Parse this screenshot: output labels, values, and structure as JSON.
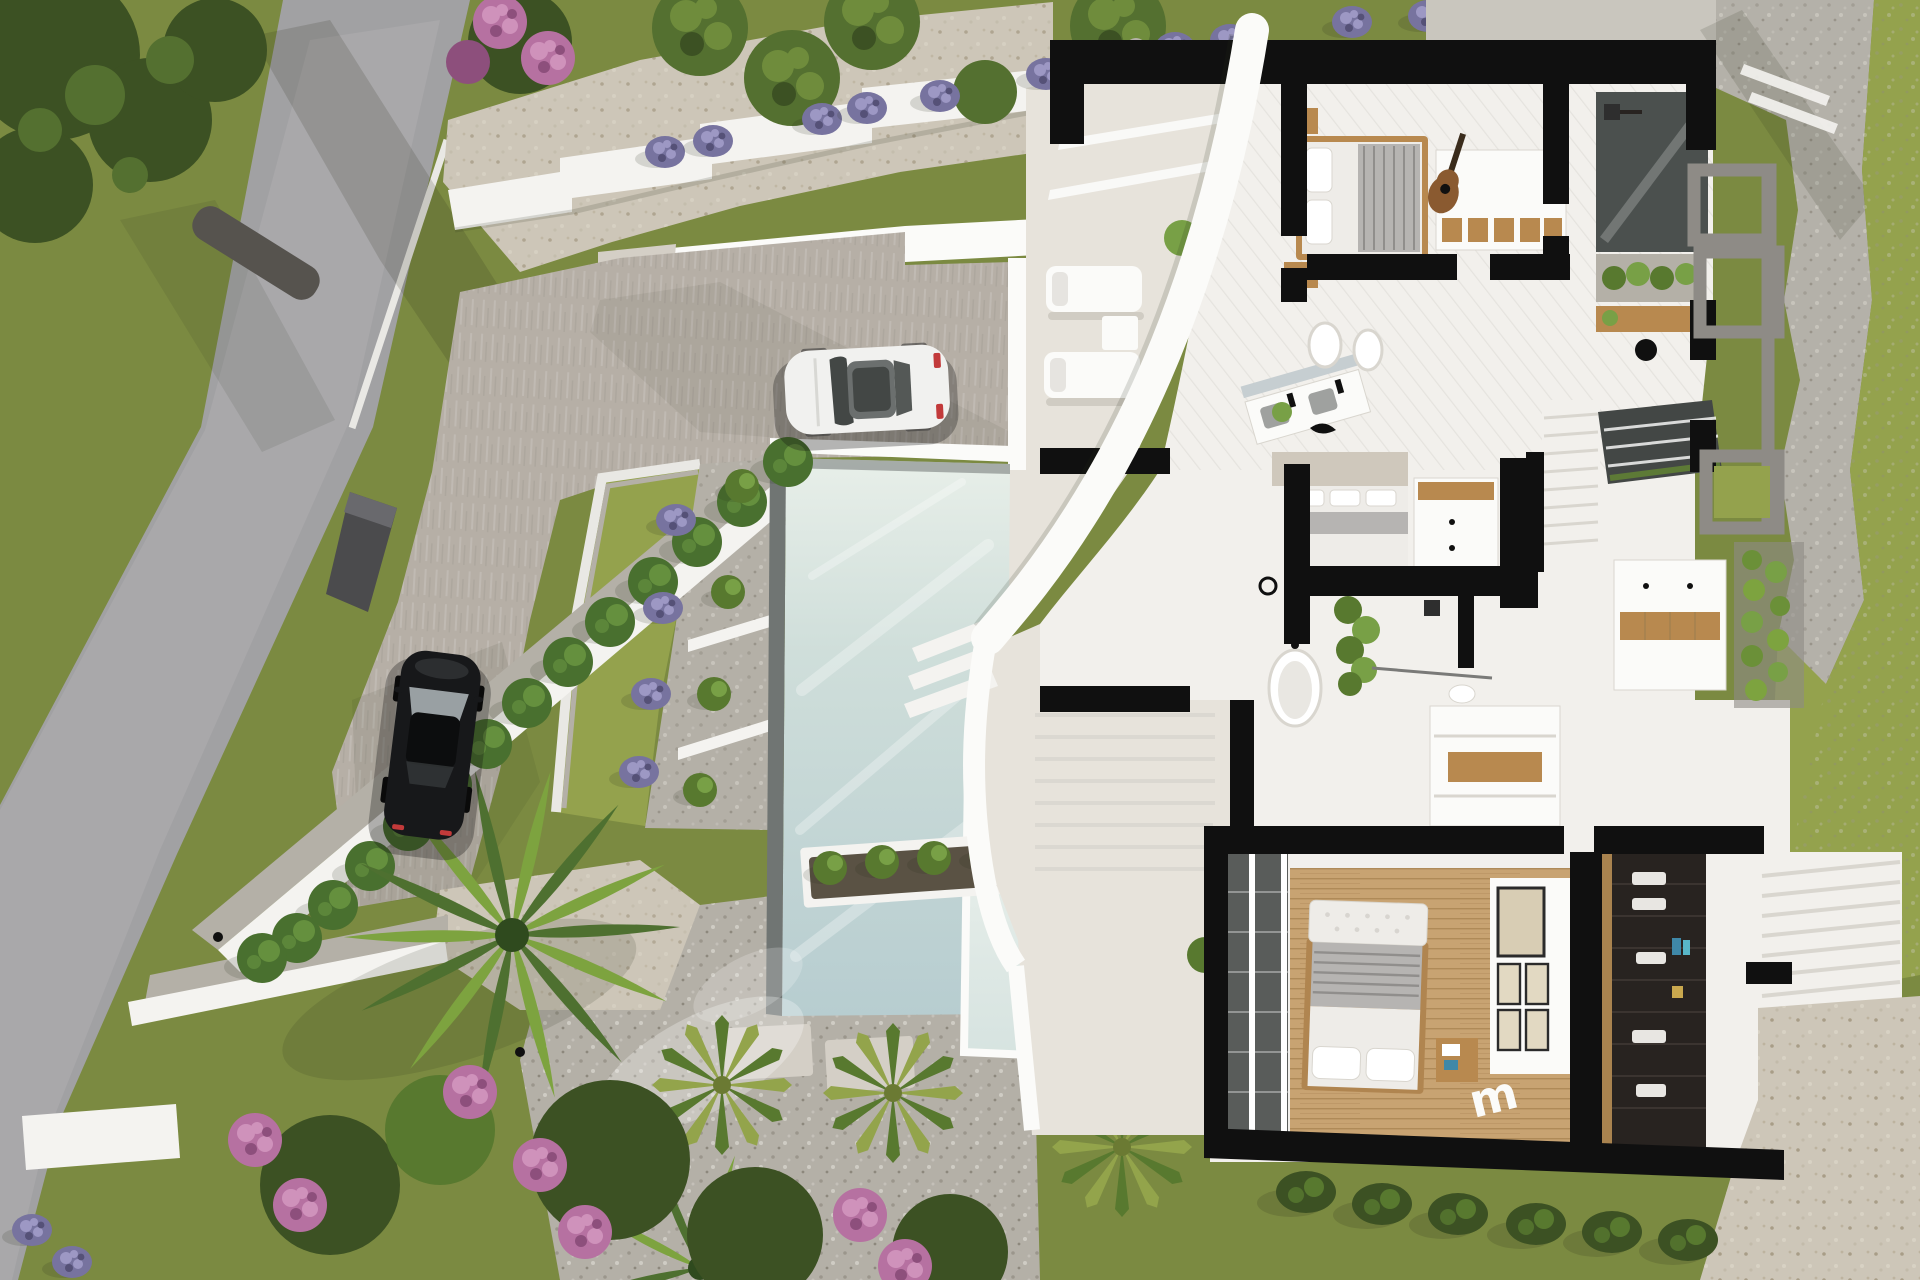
{
  "scene": {
    "kind": "aerial-3d-architectural-render",
    "description": "Top-down dollhouse render of a modern white villa: road and driveway left, lap pool with terraced planters center, cutaway floor plan with black walls right, Mediterranean landscaping",
    "decor": {
      "letter": "m"
    }
  },
  "palette": {
    "grassBase": "#7b8a41",
    "grassLight": "#94a24d",
    "grassDark": "#5f7532",
    "treeDark": "#3c5123",
    "treeMid": "#547030",
    "treeLight": "#6f8c3c",
    "road": "#a1a1a3",
    "roadLight": "#b6b5b7",
    "curb": "#e9e8e4",
    "gravelBeige": "#cdc6b8",
    "gravelGrey": "#b4b0a7",
    "driveway": "#b6afa6",
    "wallWhite": "#f4f3f0",
    "wallBright": "#fbfbf9",
    "wallShade": "#d7d4ce",
    "gate": "#4b4b4d",
    "gateTop": "#69696d",
    "cypress": "#49702f",
    "cypressLight": "#65903e",
    "lavender": "#77739f",
    "lavenderDark": "#555177",
    "lavenderLight": "#9d98c4",
    "shrub": "#58792f",
    "shrubLight": "#78a046",
    "pink": "#b671a1",
    "pinkDeep": "#8d4f7c",
    "pinkLight": "#cf92bb",
    "palm": "#4e7030",
    "palmLight": "#7da33f",
    "cycad": "#93a44b",
    "poolDeep": "#b7cdd0",
    "poolMid": "#cfdeda",
    "poolPale": "#e8efe9",
    "poolTrim": "#707573",
    "coping": "#ecebe7",
    "deck": "#e7e3db",
    "deckShade": "#d4cfc6",
    "planBlack": "#101010",
    "floorWhite": "#f2f0ec",
    "floorShade": "#d9d6cf",
    "woodFloor": "#c8a372",
    "woodDark": "#a9834f",
    "furnWood": "#b8894f",
    "bedWhite": "#eeece8",
    "duvetGrey": "#b6b4b2",
    "stripeGrey": "#908e8c",
    "closetDark": "#282320",
    "glassDark": "#434745",
    "mirror": "#c6ced1",
    "stone": "#b4b1a9",
    "stoneDark": "#98948a",
    "stoneLight": "#c9c6be",
    "frameGrey": "#8e8b86",
    "greenWall": "#6b9038",
    "pureWhite": "#ffffff",
    "carWhite": "#f1f1ef",
    "carBlack": "#17181a",
    "tailRed": "#c23a3a",
    "beigeTex": "#cfc8bc",
    "logGrey": "#56534e",
    "shadowSoft": "rgba(40,45,25,0.30)",
    "shadowHard": "rgba(15,15,15,0.30)"
  },
  "objects": {
    "ground": [
      "grass-lawn",
      "asphalt-road",
      "gravel-path",
      "pebble-ground",
      "stone-terrain",
      "paved-driveway"
    ],
    "structures": [
      "retaining-walls",
      "stepped-walls",
      "garage-roof-slab",
      "curved-facade",
      "entrance-gate",
      "floor-plan-cutaway"
    ],
    "pool": [
      "main-pool",
      "sun-shelf-pool",
      "in-water-loungers",
      "stepping-stones",
      "planter-trough"
    ],
    "vehicles": [
      "white-sports-car",
      "black-car"
    ],
    "vegetation": [
      "olive-trees",
      "cypress-hedge",
      "lavender-row",
      "palm-tree",
      "cycads",
      "bougainvillea",
      "vertical-garden"
    ],
    "interior": [
      "bedroom-1",
      "bedroom-2",
      "master-bedroom",
      "bathrooms",
      "freestanding-tub",
      "walk-in-closet",
      "staircases",
      "gallery-wall",
      "wardrobe",
      "guitar"
    ]
  }
}
